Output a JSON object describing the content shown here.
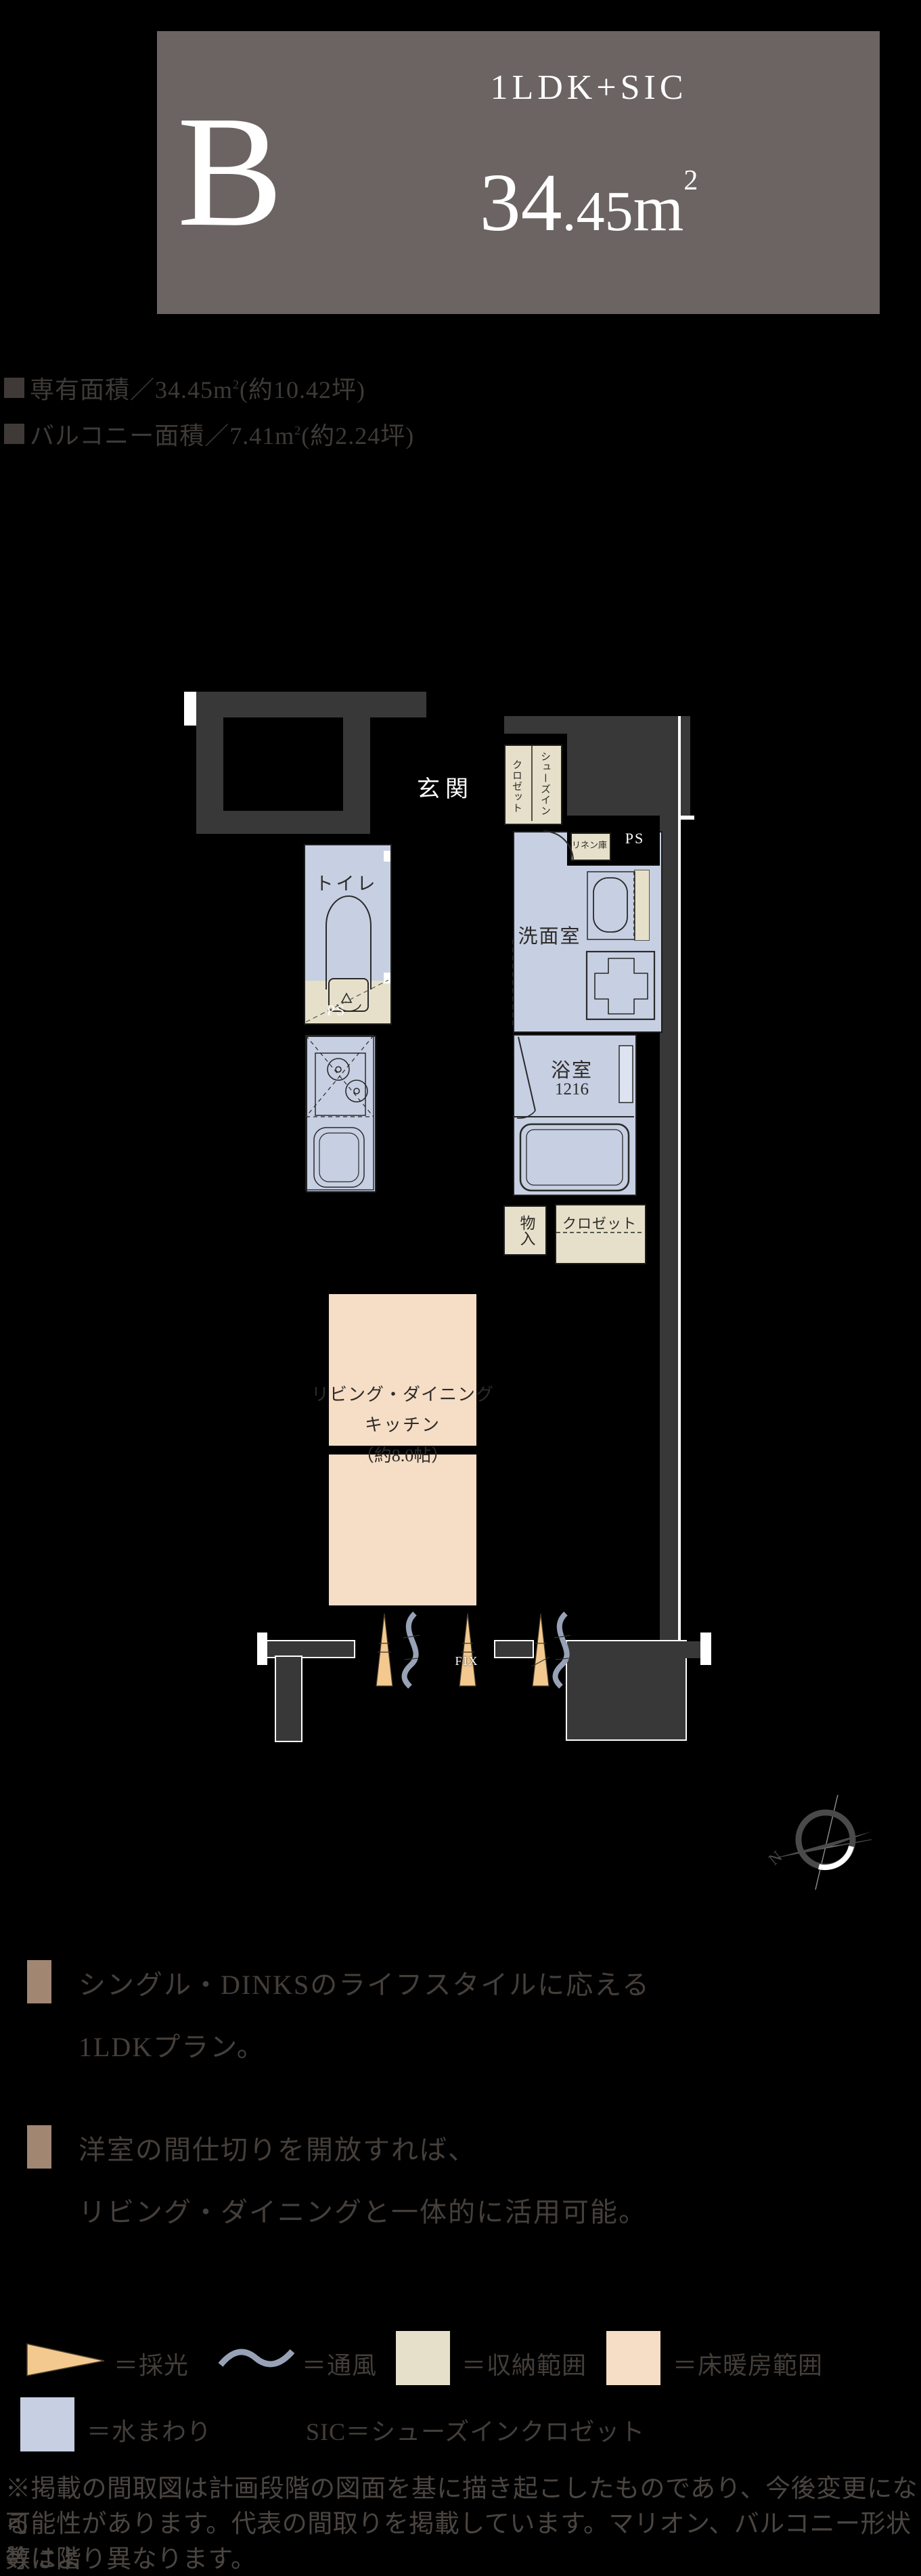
{
  "header": {
    "type_label": "B",
    "layout_label": "1LDK+SIC",
    "area_main": "34",
    "area_dec": ".45",
    "area_unit": "m",
    "area_sup": "2"
  },
  "area_info": {
    "rows": [
      {
        "prefix": "専有面積／34.45m",
        "sup": "2",
        "suffix": "(約10.42坪)"
      },
      {
        "prefix": "バルコニー面積／7.41m",
        "sup": "2",
        "suffix": "(約2.24坪)"
      }
    ]
  },
  "floor_plan": {
    "labels": {
      "entrance": "玄関",
      "sic_col1": "シューズイン",
      "sic_col2": "クロゼット",
      "linen": "リネン庫",
      "ps_top": "PS",
      "toilet": "トイレ",
      "ps_toilet": "PS",
      "washroom": "洗面室",
      "bath": "浴室",
      "bath_size": "1216",
      "storage": "物入",
      "closet": "クロゼット",
      "ldk_line1": "リビング・ダイニング",
      "ldk_line2": "キッチン",
      "ldk_line3": "（約8.0帖）",
      "fix": "FIX",
      "compass_north": "N"
    }
  },
  "features": [
    {
      "lines": [
        "シングル・DINKSのライフスタイルに応える",
        "1LDKプラン。"
      ]
    },
    {
      "lines": [
        "洋室の間仕切りを開放すれば、",
        "リビング・ダイニングと一体的に活用可能。"
      ]
    }
  ],
  "legend": {
    "daylight_label": "＝採光",
    "airflow_label": "＝通風",
    "storage_label": "＝収納範囲",
    "floor_heating_label": "＝床暖房範囲",
    "water_label": "＝水まわり",
    "sic_note": "SIC＝シューズインクロゼット"
  },
  "disclaimer": {
    "lines": [
      "※掲載の間取図は計画段階の図面を基に描き起こしたものであり、今後変更になる",
      "可能性があります。代表の間取りを掲載しています。マリオン、バルコニー形状等は階",
      "数により異なります。"
    ]
  },
  "colors": {
    "header_bg": "#6b6462",
    "wall": "#383838",
    "water": "#c7cfe2",
    "storage": "#e6e0ca",
    "floor_heating": "#f6ddc6",
    "daylight": "#f3c98f",
    "airflow": "#98a2b6",
    "feature_bullet": "#a18672"
  }
}
